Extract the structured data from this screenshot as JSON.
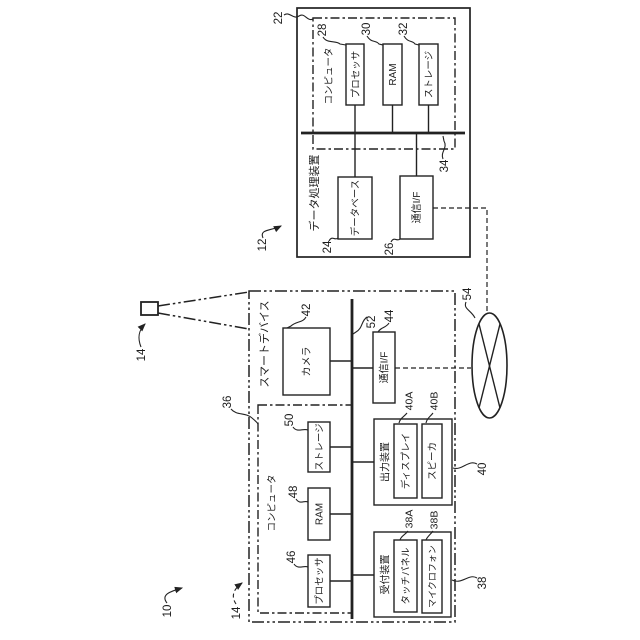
{
  "figure": {
    "type": "patent-block-diagram",
    "orientation": "rotated-90-ccw-text",
    "stroke_color": "#222222",
    "background": "#ffffff",
    "refs": {
      "system": "10",
      "data_processing_device": "12",
      "device_icon": "14",
      "smart_device": "14",
      "dpd_computer": "22",
      "database": "24",
      "dpd_comm_if": "26",
      "dpd_processor": "28",
      "dpd_ram": "30",
      "dpd_storage": "32",
      "dpd_bus": "34",
      "sd_computer": "36",
      "reception_device": "38",
      "touch_panel": "38A",
      "microphone": "38B",
      "output_device": "40",
      "display": "40A",
      "speaker": "40B",
      "camera": "42",
      "sd_comm_if": "44",
      "sd_processor": "46",
      "sd_ram": "48",
      "sd_storage": "50",
      "sd_bus": "52",
      "network": "54"
    },
    "labels": {
      "data_processing_device": "データ処理装置",
      "dpd_computer": "コンピュータ",
      "dpd_processor": "プロセッサ",
      "dpd_ram": "RAM",
      "dpd_storage": "ストレージ",
      "database": "データベース",
      "dpd_comm_if": "通信I/F",
      "smart_device": "スマートデバイス",
      "camera": "カメラ",
      "sd_comm_if": "通信I/F",
      "sd_computer": "コンピュータ",
      "sd_storage": "ストレージ",
      "sd_ram": "RAM",
      "sd_processor": "プロセッサ",
      "output_device": "出力装置",
      "display": "ディスプレイ",
      "speaker": "スピーカ",
      "reception_device": "受付装置",
      "touch_panel": "タッチパネル",
      "microphone": "マイクロフォン"
    }
  }
}
